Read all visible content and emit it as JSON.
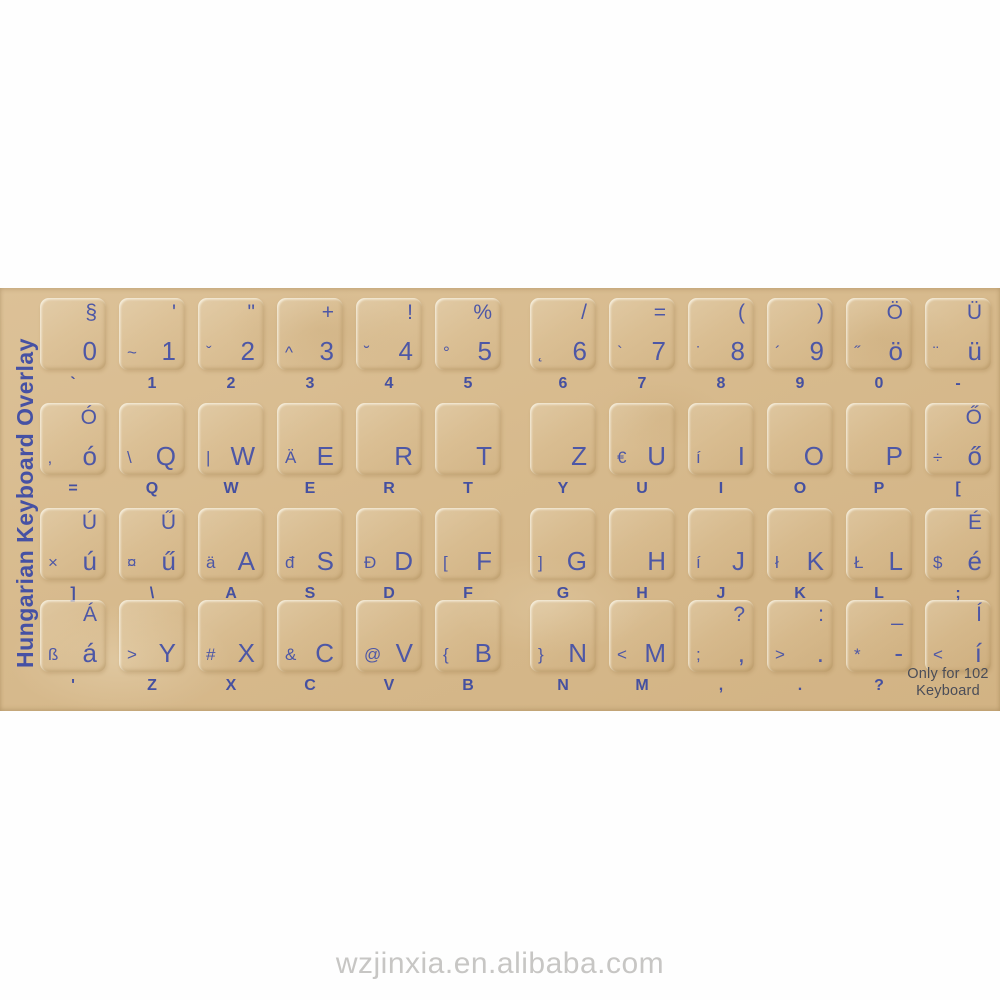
{
  "photo": {
    "side_label": "Hungarian Keyboard Overlay",
    "watermark": "wzjinxia.en.alibaba.com",
    "footnote": {
      "line1": "Only for 102",
      "line2": "Keyboard"
    }
  },
  "colors": {
    "letter_blue": "#4d57a6",
    "sheet_tan": "#d7ba8d",
    "footnote_gray": "#4a4d58",
    "watermark_gray": "#c7c6c4"
  },
  "rows": [
    {
      "keys": [
        {
          "tr": "§",
          "bl": "",
          "br": "0",
          "below": "`"
        },
        {
          "tr": "'",
          "bl": "~",
          "br": "1",
          "below": "1"
        },
        {
          "tr": "\"",
          "bl": "ˇ",
          "br": "2",
          "below": "2"
        },
        {
          "tr": "+",
          "bl": "^",
          "br": "3",
          "below": "3"
        },
        {
          "tr": "!",
          "bl": "˘",
          "br": "4",
          "below": "4"
        },
        {
          "tr": "%",
          "bl": "°",
          "br": "5",
          "below": "5"
        },
        {
          "tr": "/",
          "bl": "˛",
          "br": "6",
          "below": "6"
        },
        {
          "tr": "=",
          "bl": "`",
          "br": "7",
          "below": "7"
        },
        {
          "tr": "(",
          "bl": "˙",
          "br": "8",
          "below": "8"
        },
        {
          "tr": ")",
          "bl": "´",
          "br": "9",
          "below": "9"
        },
        {
          "tr": "Ö",
          "bl": "˝",
          "br": "ö",
          "below": "0"
        },
        {
          "tr": "Ü",
          "bl": "¨",
          "br": "ü",
          "below": "-"
        }
      ]
    },
    {
      "keys": [
        {
          "tr": "Ó",
          "bl": "‚",
          "br": "ó",
          "below": "="
        },
        {
          "tr": "",
          "bl": "\\",
          "br": "Q",
          "below": "Q"
        },
        {
          "tr": "",
          "bl": "|",
          "br": "W",
          "below": "W"
        },
        {
          "tr": "",
          "bl": "Ä",
          "br": "E",
          "below": "E"
        },
        {
          "tr": "",
          "bl": "",
          "br": "R",
          "below": "R"
        },
        {
          "tr": "",
          "bl": "",
          "br": "T",
          "below": "T"
        },
        {
          "tr": "",
          "bl": "",
          "br": "Z",
          "below": "Y"
        },
        {
          "tr": "",
          "bl": "€",
          "br": "U",
          "below": "U"
        },
        {
          "tr": "",
          "bl": "í",
          "br": "I",
          "below": "I"
        },
        {
          "tr": "",
          "bl": "",
          "br": "O",
          "below": "O"
        },
        {
          "tr": "",
          "bl": "",
          "br": "P",
          "below": "P"
        },
        {
          "tr": "Ő",
          "bl": "÷",
          "br": "ő",
          "below": "["
        }
      ]
    },
    {
      "keys": [
        {
          "tr": "Ú",
          "bl": "×",
          "br": "ú",
          "below": "]"
        },
        {
          "tr": "Ű",
          "bl": "¤",
          "br": "ű",
          "below": "\\"
        },
        {
          "tr": "",
          "bl": "ä",
          "br": "A",
          "below": "A"
        },
        {
          "tr": "",
          "bl": "đ",
          "br": "S",
          "below": "S"
        },
        {
          "tr": "",
          "bl": "Đ",
          "br": "D",
          "below": "D"
        },
        {
          "tr": "",
          "bl": "[",
          "br": "F",
          "below": "F"
        },
        {
          "tr": "",
          "bl": "]",
          "br": "G",
          "below": "G"
        },
        {
          "tr": "",
          "bl": "",
          "br": "H",
          "below": "H"
        },
        {
          "tr": "",
          "bl": "í",
          "br": "J",
          "below": "J"
        },
        {
          "tr": "",
          "bl": "ł",
          "br": "K",
          "below": "K"
        },
        {
          "tr": "",
          "bl": "Ł",
          "br": "L",
          "below": "L"
        },
        {
          "tr": "É",
          "bl": "$",
          "br": "é",
          "below": ";"
        }
      ]
    },
    {
      "keys": [
        {
          "tr": "Á",
          "bl": "ß",
          "br": "á",
          "below": "'"
        },
        {
          "tr": "",
          "bl": ">",
          "br": "Y",
          "below": "Z"
        },
        {
          "tr": "",
          "bl": "#",
          "br": "X",
          "below": "X"
        },
        {
          "tr": "",
          "bl": "&",
          "br": "C",
          "below": "C"
        },
        {
          "tr": "",
          "bl": "@",
          "br": "V",
          "below": "V"
        },
        {
          "tr": "",
          "bl": "{",
          "br": "B",
          "below": "B"
        },
        {
          "tr": "",
          "bl": "}",
          "br": "N",
          "below": "N"
        },
        {
          "tr": "",
          "bl": "<",
          "br": "M",
          "below": "M"
        },
        {
          "tr": "?",
          "bl": ";",
          "br": ",",
          "below": ","
        },
        {
          "tr": ":",
          "bl": ">",
          "br": ".",
          "below": "."
        },
        {
          "tr": "_",
          "bl": "*",
          "br": "-",
          "below": "?"
        },
        {
          "tr": "Í",
          "bl": "<",
          "br": "í",
          "below": ""
        }
      ]
    }
  ]
}
